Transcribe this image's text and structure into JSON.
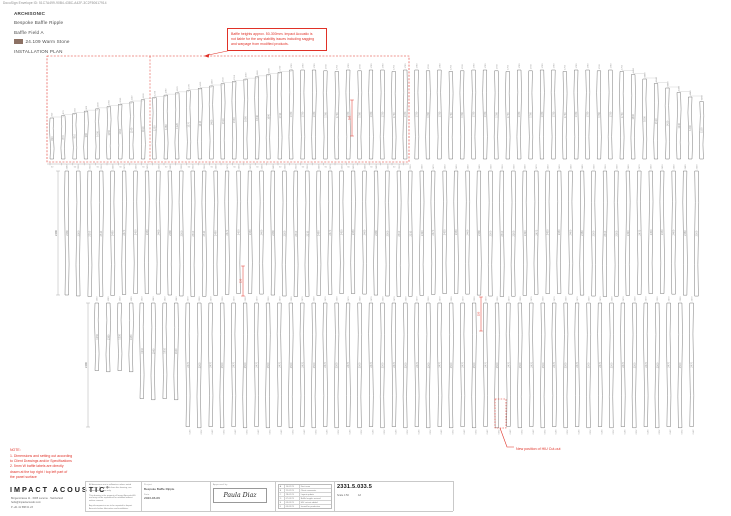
{
  "colors": {
    "red": "#e03127",
    "line": "#6a6a6a",
    "label": "#9a9a9a",
    "swatch": "#8c7164"
  },
  "meta": {
    "envelope": "DocuSign Envelope ID: 51C7A499-90B4-438C-A42F-3C2F50617914"
  },
  "header": {
    "brand": "ARCHISONIC",
    "product": "Bespoke Baffle Ripple",
    "field": "Baffle Field A",
    "color_code": "24.109 Warm Stone",
    "view_label": "INSTALLATION PLAN"
  },
  "notes": {
    "top_warning_lines": [
      "Baffle heights approx. 50-300mm. Impact Acoustic is",
      "not liable for the any stability issues including sagging",
      "and warpage from modified products."
    ],
    "hvac": "New position of HIU Cut-out",
    "bottom_note_title": "NOTE:",
    "bottom_note_lines": [
      "1. Dimensions and setting out according",
      "to Client Drawings and/or Specifications",
      "2. 5mm W baffle labels are directly",
      "drawn at the top right / top left part of",
      "the panel surface"
    ]
  },
  "titleblock": {
    "logo_impact": "IMPACT",
    "logo_acoustic": "ACOUSTIC",
    "logo_reg": "®",
    "address_lines": [
      "Bürgenstrasse 11 · 6005 Lucerne · Switzerland",
      "hello@impactacoustic.com",
      "P +41 41 588 01 23"
    ],
    "disclaimer_blocks": [
      "All dimensions are in millimetres unless noted otherwise. Do not scale from this drawing; use figured dimensions only.",
      "This drawing is the property of Impact Acoustic AG and may not be reproduced or modified without written consent.",
      "Any discrepancies are to be reported to Impact Acoustic before fabrication and installation."
    ],
    "fields": [
      {
        "label": "Project",
        "value": "Bespoke Baffle Ripple"
      },
      {
        "label": "Date",
        "value": "2023-03-09"
      }
    ],
    "approved_label": "Approved by",
    "signature": "Paula Diaz",
    "revisions": [
      [
        "A",
        "10.02.23",
        "First issue"
      ],
      [
        "B",
        "21.02.23",
        "Client comments"
      ],
      [
        "C",
        "28.02.23",
        "Layout update"
      ],
      [
        "D",
        "07.03.23",
        "Baffle lengths revised"
      ],
      [
        "E",
        "09.03.23",
        "HIU cut-out added"
      ],
      [
        "F",
        "09.03.23",
        "Issued for production"
      ]
    ],
    "drawing_number": "2331.5.033.5",
    "scale_label": "Scale",
    "scale_value": "1:50",
    "sheet_size": "A3"
  },
  "drawing": {
    "baffle_width": 3.6,
    "mm_per_px": 20,
    "band1": {
      "x0": 50,
      "dx": 11.4,
      "count": 58,
      "bottom": 159,
      "plateau_top": 70,
      "left_start_top": 118,
      "left_ramp_end": 21,
      "right_ramp_start": 51,
      "right_step": 4.5
    },
    "band2": {
      "x0": 65,
      "dx": 11.45,
      "count": 56,
      "top": 171,
      "bottom": 295
    },
    "band3": {
      "dx": 11.45,
      "segments": [
        {
          "x0": 95,
          "count": 4,
          "top": 303,
          "bottom": 371
        },
        {
          "x0": 140,
          "count": 4,
          "top": 303,
          "bottom": 399
        },
        {
          "x0": 186,
          "count": 45,
          "top": 303,
          "bottom": 427
        }
      ]
    },
    "red_box": {
      "x": 47,
      "y": 56,
      "w": 362,
      "h": 106
    },
    "red_inner_line_x": 150,
    "dim_chain": {
      "y": 164,
      "x1": 47,
      "x2": 409,
      "tick_label": "60"
    },
    "left_dims": [
      {
        "x": 58,
        "y1": 171,
        "y2": 295,
        "label": "2480"
      },
      {
        "x": 88,
        "y1": 303,
        "y2": 427,
        "label": "2480"
      }
    ],
    "red_dims": [
      {
        "x": 352,
        "y1": 100,
        "y2": 136,
        "label": "300"
      },
      {
        "x": 243,
        "y1": 266,
        "y2": 296,
        "label": "150"
      },
      {
        "x": 481,
        "y1": 297,
        "y2": 331,
        "label": "150"
      }
    ],
    "hvac_box": {
      "x": 495,
      "y": 399,
      "w": 11,
      "h": 29
    },
    "hvac_leader": "500,428 507,447 514,447",
    "hvac_text_pos": {
      "x": 516,
      "y": 450
    }
  }
}
